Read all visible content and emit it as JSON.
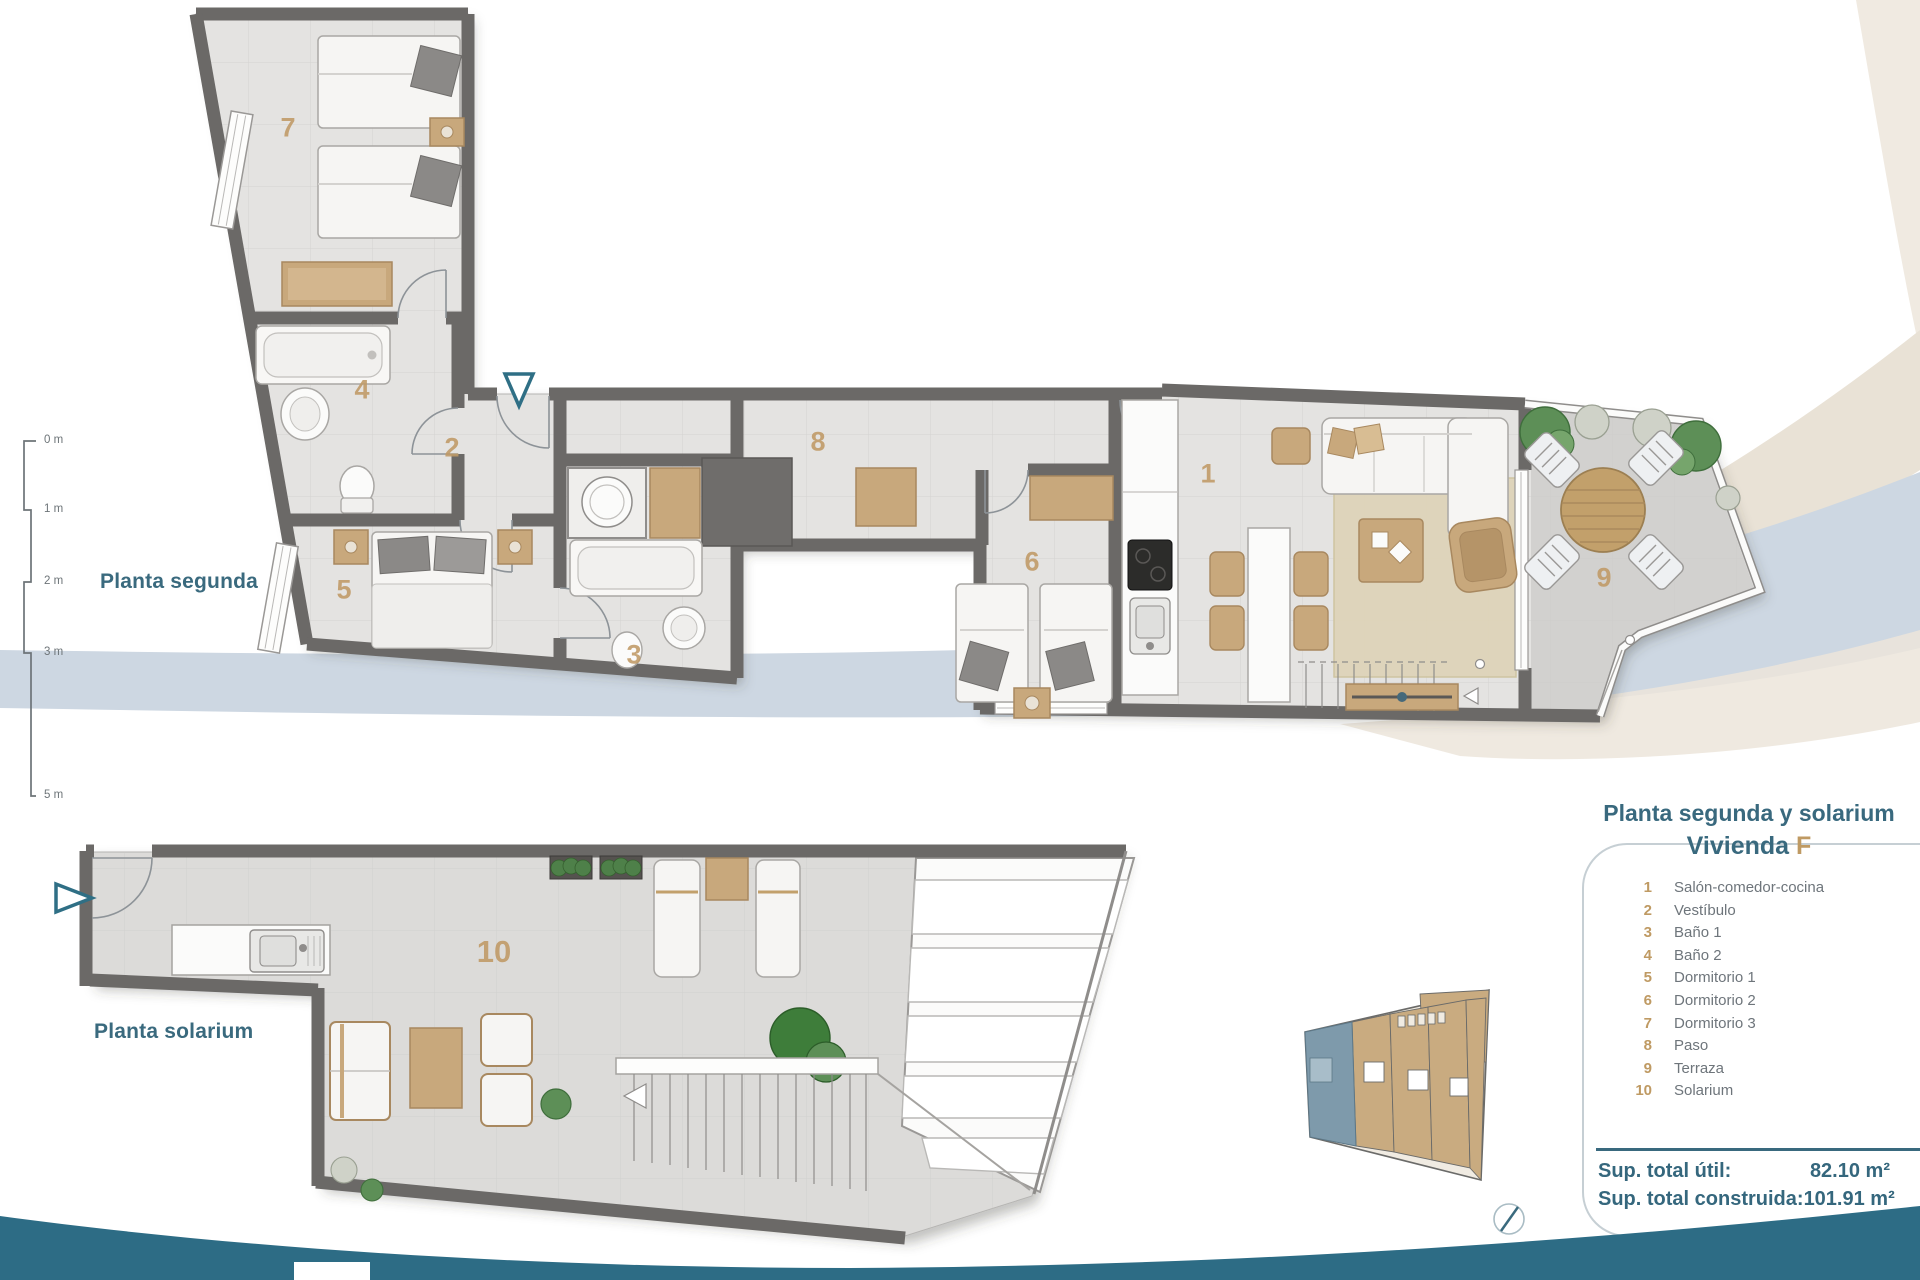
{
  "header": {
    "plan_title": "Planta segunda y solarium",
    "unit_word": "Vivienda",
    "unit_letter": "F"
  },
  "plan_labels": {
    "segunda": "Planta segunda",
    "solarium": "Planta solarium"
  },
  "scale_bar": {
    "ticks": [
      "0 m",
      "1 m",
      "2 m",
      "3 m",
      "5 m"
    ]
  },
  "legend": {
    "items": [
      {
        "num": "1",
        "label": "Salón-comedor-cocina"
      },
      {
        "num": "2",
        "label": "Vestíbulo"
      },
      {
        "num": "3",
        "label": "Baño 1"
      },
      {
        "num": "4",
        "label": "Baño 2"
      },
      {
        "num": "5",
        "label": "Dormitorio 1"
      },
      {
        "num": "6",
        "label": "Dormitorio 2"
      },
      {
        "num": "7",
        "label": "Dormitorio 3"
      },
      {
        "num": "8",
        "label": "Paso"
      },
      {
        "num": "9",
        "label": "Terraza"
      },
      {
        "num": "10",
        "label": "Solarium"
      }
    ]
  },
  "totals": {
    "rows": [
      {
        "label": "Sup. total útil:",
        "value": "82.10 m²"
      },
      {
        "label": "Sup. total construida:",
        "value": "101.91 m²"
      }
    ]
  },
  "icons": {
    "entry_arrow_floor2": "entry-direction-arrow-down",
    "entry_arrow_solarium": "entry-direction-arrow-right",
    "compass": "compass-needle"
  },
  "colors": {
    "accent_teal": "#39697e",
    "accent_tan": "#bf9a63",
    "wall_gray": "#6b6967",
    "floor_gray": "#e4e3e1",
    "footer_teal": "#2d6c85",
    "band_blue": "#cdd7e2",
    "band_cream": "#e9e2d6",
    "key_unit_highlight": "#7e9aab",
    "key_unit_tan": "#c9ab80"
  }
}
